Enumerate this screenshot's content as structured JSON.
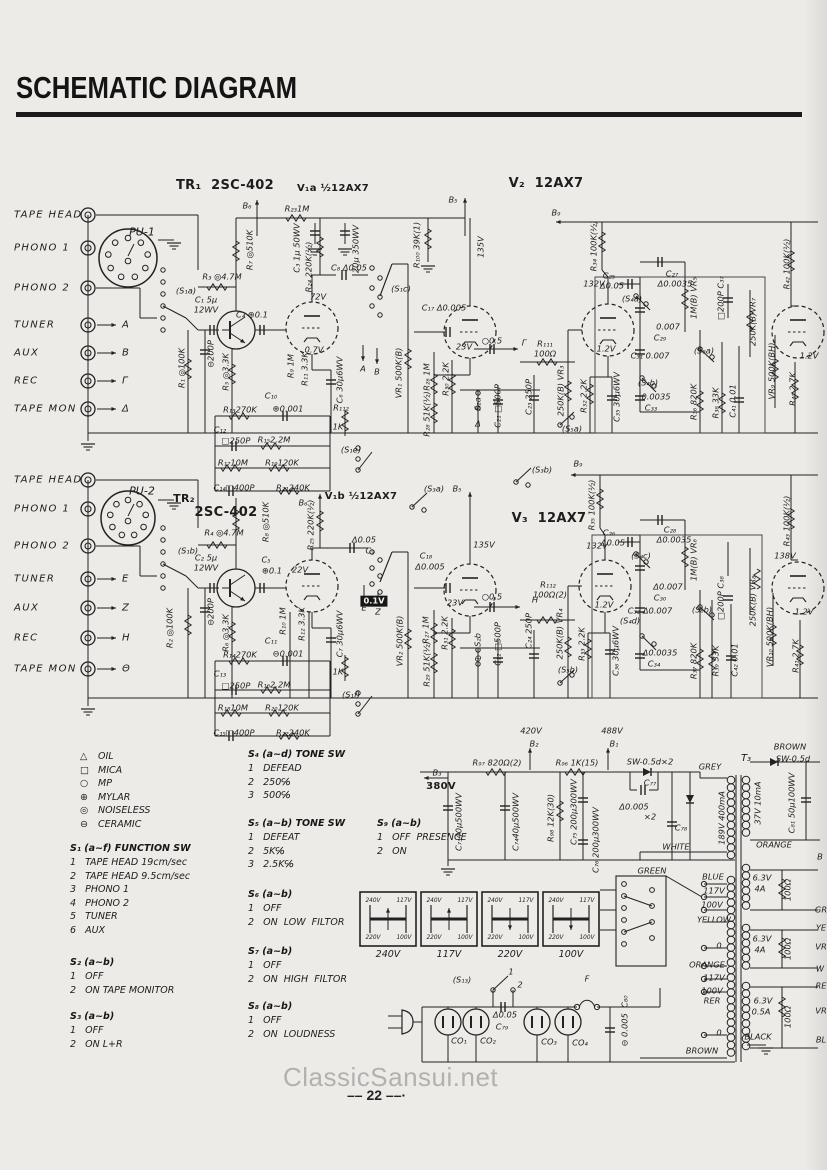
{
  "title": "SCHEMATIC DIAGRAM",
  "watermark": "ClassicSansui.net",
  "page_number": "22",
  "page_number_display": "–– 22 ––·",
  "colors": {
    "ink": "#1d1d1d",
    "paper": "#edebe7",
    "watermark_grey": "#b2b1af"
  },
  "input_groups": [
    {
      "connector": "PU-1",
      "rows": [
        {
          "label": "TAPE HEAD",
          "tag": ""
        },
        {
          "label": "PHONO  1",
          "tag": ""
        },
        {
          "label": "PHONO  2",
          "tag": ""
        },
        {
          "label": "TUNER",
          "tag": "A"
        },
        {
          "label": "AUX",
          "tag": "B"
        },
        {
          "label": "REC",
          "tag": "Γ"
        },
        {
          "label": "TAPE MON",
          "tag": "Δ"
        }
      ]
    },
    {
      "connector": "PU-2",
      "rows": [
        {
          "label": "TAPE HEAD",
          "tag": ""
        },
        {
          "label": "PHONO  1",
          "tag": ""
        },
        {
          "label": "PHONO  2",
          "tag": ""
        },
        {
          "label": "TUNER",
          "tag": "E"
        },
        {
          "label": "AUX",
          "tag": "Z"
        },
        {
          "label": "REC",
          "tag": "H"
        },
        {
          "label": "TAPE MON",
          "tag": "Θ"
        }
      ]
    }
  ],
  "legend": {
    "items": [
      [
        "△",
        "OIL"
      ],
      [
        "□",
        "MICA"
      ],
      [
        "○",
        "MP"
      ],
      [
        "⊕",
        "MYLAR"
      ],
      [
        "◎",
        "NOISELESS"
      ],
      [
        "⊖",
        "CERAMIC"
      ]
    ]
  },
  "switch_blocks": [
    {
      "title": "S₁ (a~f)  FUNCTION SW",
      "items": [
        "1   TAPE HEAD 19cm/sec",
        "2   TAPE HEAD 9.5cm/sec",
        "3   PHONO 1",
        "4   PHONO 2",
        "5   TUNER",
        "6   AUX"
      ]
    },
    {
      "title": "S₂ (a~b)",
      "items": [
        "1   OFF",
        "2   ON TAPE MONITOR"
      ]
    },
    {
      "title": "S₃ (a~b)",
      "items": [
        "1   OFF",
        "2   ON L+R"
      ]
    },
    {
      "title": "S₄ (a~d) TONE SW",
      "items": [
        "1   DEFEAD",
        "2   250℅",
        "3   500℅"
      ]
    },
    {
      "title": "S₅ (a~b) TONE SW",
      "items": [
        "1   DEFEAT",
        "2   5K℅",
        "3   2.5K℅"
      ]
    },
    {
      "title": "S₆ (a~b)",
      "items": [
        "1   OFF",
        "2   ON  LOW  FILTOR"
      ]
    },
    {
      "title": "S₇ (a~b)",
      "items": [
        "1   OFF",
        "2   ON  HIGH  FILTOR"
      ]
    },
    {
      "title": "S₈ (a~b)",
      "items": [
        "1   OFF",
        "2   ON  LOUDNESS"
      ]
    },
    {
      "title": "S₉ (a~b)",
      "items": [
        "1   OFF  PRESENCE",
        "2   ON"
      ]
    }
  ],
  "selectors": {
    "corners": [
      "240V",
      "117V",
      "220V",
      "100V"
    ],
    "captions": [
      "240V",
      "117V",
      "220V",
      "100V"
    ]
  },
  "annotations": [
    {
      "t": "TR₁  2SC-402",
      "x": 225,
      "y": 186,
      "s": 13,
      "b": 1
    },
    {
      "t": "V₁a ½12AX7",
      "x": 333,
      "y": 189,
      "s": 10,
      "b": 1
    },
    {
      "t": "V₂  12AX7",
      "x": 546,
      "y": 184,
      "s": 13,
      "b": 1
    },
    {
      "t": "B₆",
      "x": 247,
      "y": 206
    },
    {
      "t": "R₂₃1M",
      "x": 297,
      "y": 209
    },
    {
      "t": "B₅",
      "x": 453,
      "y": 200
    },
    {
      "t": "135V",
      "x": 481,
      "y": 247,
      "r": 1
    },
    {
      "t": "R₁₀₀ 39K(1)",
      "x": 417,
      "y": 245,
      "r": 1
    },
    {
      "t": "R₇ ◎510K",
      "x": 250,
      "y": 250,
      "r": 1
    },
    {
      "t": "R₃ ◎4.7M",
      "x": 222,
      "y": 277
    },
    {
      "t": "C₃ 1μ 50WV",
      "x": 297,
      "y": 248,
      "r": 1
    },
    {
      "t": "R₂₄ 220K(½)",
      "x": 309,
      "y": 267,
      "r": 1
    },
    {
      "t": "20μ 350WV",
      "x": 356,
      "y": 249,
      "r": 1
    },
    {
      "t": "C₈ Δ0.05",
      "x": 349,
      "y": 268
    },
    {
      "t": "(S₁c)",
      "x": 401,
      "y": 289
    },
    {
      "t": "C₁₇ Δ0.005",
      "x": 444,
      "y": 308
    },
    {
      "t": "(S₁a)",
      "x": 186,
      "y": 291
    },
    {
      "t": "C₁ 5μ",
      "x": 206,
      "y": 300
    },
    {
      "t": "12WV",
      "x": 206,
      "y": 310
    },
    {
      "t": "C₄ ⊕0.1",
      "x": 252,
      "y": 315
    },
    {
      "t": "72V",
      "x": 318,
      "y": 297
    },
    {
      "t": "0.7V",
      "x": 314,
      "y": 350
    },
    {
      "t": "23V",
      "x": 464,
      "y": 347
    },
    {
      "t": "A",
      "x": 363,
      "y": 369
    },
    {
      "t": "B",
      "x": 377,
      "y": 372
    },
    {
      "t": "⊖200P",
      "x": 211,
      "y": 354,
      "r": 1
    },
    {
      "t": "R₁ ◎100K",
      "x": 182,
      "y": 368,
      "r": 1
    },
    {
      "t": "R₅ ◎3.3K",
      "x": 226,
      "y": 372,
      "r": 1
    },
    {
      "t": "R₉ 1M",
      "x": 291,
      "y": 366,
      "r": 1
    },
    {
      "t": "R₁₁ 3.3K",
      "x": 305,
      "y": 369,
      "r": 1
    },
    {
      "t": "C₆ 30μ6WV",
      "x": 340,
      "y": 380,
      "r": 1
    },
    {
      "t": "VR₁ 500K(B)",
      "x": 399,
      "y": 373,
      "r": 1
    },
    {
      "t": "○0.5",
      "x": 492,
      "y": 341
    },
    {
      "t": "Γ",
      "x": 524,
      "y": 343
    },
    {
      "t": "R₂₆ 1M",
      "x": 427,
      "y": 377,
      "r": 1
    },
    {
      "t": "R₃₀ 2.2K",
      "x": 446,
      "y": 379,
      "r": 1
    },
    {
      "t": "R₂₈ 51K(½)",
      "x": 427,
      "y": 414,
      "r": 1
    },
    {
      "t": "S₂a",
      "x": 478,
      "y": 404,
      "r": 1
    },
    {
      "t": "Δ",
      "x": 478,
      "y": 424
    },
    {
      "t": "C₂₁ □500P",
      "x": 498,
      "y": 406,
      "r": 1
    },
    {
      "t": "C₂₃ 250P",
      "x": 529,
      "y": 397,
      "r": 1
    },
    {
      "t": "R₁₁₁",
      "x": 545,
      "y": 344
    },
    {
      "t": "100Ω",
      "x": 545,
      "y": 354
    },
    {
      "t": "250K(B) VR₃",
      "x": 561,
      "y": 391,
      "r": 1
    },
    {
      "t": "(S₅a)",
      "x": 572,
      "y": 429
    },
    {
      "t": "R₃₂ 2.2K",
      "x": 584,
      "y": 396,
      "r": 1
    },
    {
      "t": "C₃₅ 30μ6WV",
      "x": 617,
      "y": 397,
      "r": 1
    },
    {
      "t": "1.2V",
      "x": 606,
      "y": 349
    },
    {
      "t": "132V",
      "x": 594,
      "y": 284
    },
    {
      "t": "C₂₅",
      "x": 609,
      "y": 276
    },
    {
      "t": "Δ0.05",
      "x": 612,
      "y": 286
    },
    {
      "t": "(S₄a)",
      "x": 632,
      "y": 299
    },
    {
      "t": "C₂₇",
      "x": 672,
      "y": 274
    },
    {
      "t": "Δ0.0035",
      "x": 675,
      "y": 284
    },
    {
      "t": "1M(B) VR₅",
      "x": 694,
      "y": 298,
      "r": 1
    },
    {
      "t": "0.007",
      "x": 668,
      "y": 327
    },
    {
      "t": "C₂₉",
      "x": 660,
      "y": 338
    },
    {
      "t": "C₃₁ 0.007",
      "x": 650,
      "y": 356
    },
    {
      "t": "(S₄b)",
      "x": 648,
      "y": 383
    },
    {
      "t": "0.0035",
      "x": 656,
      "y": 397
    },
    {
      "t": "C₃₃",
      "x": 651,
      "y": 408
    },
    {
      "t": "R₃₆ 820K",
      "x": 694,
      "y": 402,
      "r": 1
    },
    {
      "t": "R₃₈ 33K",
      "x": 716,
      "y": 403,
      "r": 1
    },
    {
      "t": "C₄₁ 0.01",
      "x": 733,
      "y": 401,
      "r": 1
    },
    {
      "t": "(S₈a)",
      "x": 704,
      "y": 351
    },
    {
      "t": "□200P C₃₇",
      "x": 721,
      "y": 298,
      "r": 1
    },
    {
      "t": "250K(B)VR₇",
      "x": 753,
      "y": 322,
      "r": 1
    },
    {
      "t": "VR₉ 500K(BH)",
      "x": 772,
      "y": 371,
      "r": 1
    },
    {
      "t": "R₄₀ 2.7K",
      "x": 793,
      "y": 389,
      "r": 1
    },
    {
      "t": "R₄₂ 100K(½)",
      "x": 787,
      "y": 264,
      "r": 1
    },
    {
      "t": "1.2V",
      "x": 809,
      "y": 356
    },
    {
      "t": "R₃₄ 100K(½)",
      "x": 594,
      "y": 246,
      "r": 1
    },
    {
      "t": "B₉",
      "x": 556,
      "y": 213
    },
    {
      "t": "R₁₃270K",
      "x": 240,
      "y": 410
    },
    {
      "t": "C₁₀",
      "x": 271,
      "y": 396
    },
    {
      "t": "⊕0.001",
      "x": 288,
      "y": 409
    },
    {
      "t": "C₁₂",
      "x": 220,
      "y": 430
    },
    {
      "t": "□250P",
      "x": 236,
      "y": 441
    },
    {
      "t": "R₁₅2.2M",
      "x": 274,
      "y": 440
    },
    {
      "t": "R₁₁₂",
      "x": 341,
      "y": 408
    },
    {
      "t": "1K",
      "x": 338,
      "y": 427
    },
    {
      "t": "R₁₇10M",
      "x": 233,
      "y": 463
    },
    {
      "t": "R₁₉120K",
      "x": 282,
      "y": 463
    },
    {
      "t": "C₁₄□400P",
      "x": 234,
      "y": 488
    },
    {
      "t": "R₂₁240K",
      "x": 293,
      "y": 488
    },
    {
      "t": "(S₁e)",
      "x": 351,
      "y": 450
    },
    {
      "t": "(S₃a)",
      "x": 434,
      "y": 489
    },
    {
      "t": "(S₃b)",
      "x": 542,
      "y": 470
    },
    {
      "t": "B₉",
      "x": 578,
      "y": 464
    },
    {
      "t": "B₅",
      "x": 457,
      "y": 489
    },
    {
      "t": "TR₂",
      "x": 184,
      "y": 499,
      "s": 11,
      "b": 1
    },
    {
      "t": "2SC-402",
      "x": 226,
      "y": 513,
      "s": 13,
      "b": 1
    },
    {
      "t": "V₁b ½12AX7",
      "x": 361,
      "y": 497,
      "s": 10,
      "b": 1
    },
    {
      "t": "V₃  12AX7",
      "x": 549,
      "y": 519,
      "s": 13,
      "b": 1
    },
    {
      "t": "B₆",
      "x": 303,
      "y": 503
    },
    {
      "t": "R₂₅ 220K(½)",
      "x": 311,
      "y": 525,
      "r": 1
    },
    {
      "t": "R₈ ◎510K",
      "x": 266,
      "y": 522,
      "r": 1
    },
    {
      "t": "R₄ ◎4.7M",
      "x": 224,
      "y": 533
    },
    {
      "t": "(S₁b)",
      "x": 188,
      "y": 551
    },
    {
      "t": "C₂ 5μ",
      "x": 206,
      "y": 558
    },
    {
      "t": "12WV",
      "x": 206,
      "y": 568
    },
    {
      "t": "⊖200P",
      "x": 211,
      "y": 612,
      "r": 1
    },
    {
      "t": "R₂ ◎100K",
      "x": 170,
      "y": 628,
      "r": 1
    },
    {
      "t": "R₆ ◎3.3K",
      "x": 226,
      "y": 633,
      "r": 1
    },
    {
      "t": "C₅",
      "x": 266,
      "y": 560
    },
    {
      "t": "⊕0.1",
      "x": 272,
      "y": 571
    },
    {
      "t": "22V",
      "x": 300,
      "y": 570
    },
    {
      "t": "Δ0.05",
      "x": 364,
      "y": 540
    },
    {
      "t": "C₉",
      "x": 370,
      "y": 551
    },
    {
      "t": "0.1V",
      "x": 374,
      "y": 601,
      "w": 1
    },
    {
      "t": "E",
      "x": 364,
      "y": 608
    },
    {
      "t": "Z",
      "x": 378,
      "y": 612
    },
    {
      "t": "R₁₀ 1M",
      "x": 283,
      "y": 621,
      "r": 1
    },
    {
      "t": "R₁₂ 3.3K",
      "x": 302,
      "y": 624,
      "r": 1
    },
    {
      "t": "C₇ 30μ6WV",
      "x": 340,
      "y": 634,
      "r": 1
    },
    {
      "t": "VR₂ 500K(B)",
      "x": 400,
      "y": 641,
      "r": 1
    },
    {
      "t": "C₁₈",
      "x": 426,
      "y": 556
    },
    {
      "t": "Δ0.005",
      "x": 430,
      "y": 567
    },
    {
      "t": "135V",
      "x": 484,
      "y": 545
    },
    {
      "t": "23V",
      "x": 455,
      "y": 603
    },
    {
      "t": "○0.5",
      "x": 492,
      "y": 597
    },
    {
      "t": "H",
      "x": 535,
      "y": 600
    },
    {
      "t": "R₂₇ 1M",
      "x": 426,
      "y": 630,
      "r": 1
    },
    {
      "t": "R₃₁ 2.2K",
      "x": 445,
      "y": 633,
      "r": 1
    },
    {
      "t": "R₂₉ 51K(½)",
      "x": 427,
      "y": 664,
      "r": 1
    },
    {
      "t": "S₂b",
      "x": 478,
      "y": 640,
      "r": 1
    },
    {
      "t": "Θ",
      "x": 478,
      "y": 659
    },
    {
      "t": "C₂₂ □500P",
      "x": 498,
      "y": 644,
      "r": 1
    },
    {
      "t": "C₂₄ 250P",
      "x": 529,
      "y": 631,
      "r": 1
    },
    {
      "t": "R₁₁₂",
      "x": 548,
      "y": 585
    },
    {
      "t": "100Ω(2)",
      "x": 550,
      "y": 595
    },
    {
      "t": "250K(B) VR₄",
      "x": 560,
      "y": 634,
      "r": 1
    },
    {
      "t": "(S₅b)",
      "x": 568,
      "y": 670
    },
    {
      "t": "R₃₃ 2.2K",
      "x": 582,
      "y": 644,
      "r": 1
    },
    {
      "t": "C₃₆ 30μ6WV",
      "x": 616,
      "y": 651,
      "r": 1
    },
    {
      "t": "1.2V",
      "x": 604,
      "y": 605
    },
    {
      "t": "(S₄d)",
      "x": 630,
      "y": 621
    },
    {
      "t": "132V",
      "x": 597,
      "y": 546
    },
    {
      "t": "C₂₆",
      "x": 609,
      "y": 533
    },
    {
      "t": "Δ0.05",
      "x": 613,
      "y": 543
    },
    {
      "t": "(S₄c)",
      "x": 641,
      "y": 556
    },
    {
      "t": "C₂₈",
      "x": 670,
      "y": 530
    },
    {
      "t": "Δ0.0035",
      "x": 674,
      "y": 540
    },
    {
      "t": "1M(B) VR₆",
      "x": 694,
      "y": 560,
      "r": 1
    },
    {
      "t": "Δ0.007",
      "x": 668,
      "y": 587
    },
    {
      "t": "C₃₀",
      "x": 660,
      "y": 598
    },
    {
      "t": "C₃₂ Δ0.007",
      "x": 650,
      "y": 611
    },
    {
      "t": "Δ0.0035",
      "x": 660,
      "y": 653
    },
    {
      "t": "C₃₄",
      "x": 654,
      "y": 664
    },
    {
      "t": "R₃₇ 820K",
      "x": 694,
      "y": 661,
      "r": 1
    },
    {
      "t": "R₃₉ 33K",
      "x": 716,
      "y": 661,
      "r": 1
    },
    {
      "t": "C₄₂ 0.01",
      "x": 735,
      "y": 660,
      "r": 1
    },
    {
      "t": "(S₈b)",
      "x": 702,
      "y": 610
    },
    {
      "t": "□200P C₃₈",
      "x": 721,
      "y": 598,
      "r": 1
    },
    {
      "t": "250K(B) VR₈",
      "x": 753,
      "y": 601,
      "r": 1
    },
    {
      "t": "VR₁₀ 500K(BH)",
      "x": 770,
      "y": 637,
      "r": 1
    },
    {
      "t": "R₄₁ 2.7K",
      "x": 796,
      "y": 656,
      "r": 1
    },
    {
      "t": "R₄₃ 100K(½)",
      "x": 787,
      "y": 521,
      "r": 1
    },
    {
      "t": "138V",
      "x": 785,
      "y": 556
    },
    {
      "t": "1.2V",
      "x": 804,
      "y": 612
    },
    {
      "t": "R₃₅ 100K(½)",
      "x": 592,
      "y": 505,
      "r": 1
    },
    {
      "t": "R₁₄270K",
      "x": 240,
      "y": 655
    },
    {
      "t": "C₁₁",
      "x": 271,
      "y": 641
    },
    {
      "t": "⊖0.001",
      "x": 288,
      "y": 654
    },
    {
      "t": "C₁₃",
      "x": 220,
      "y": 674
    },
    {
      "t": "□250P",
      "x": 236,
      "y": 686
    },
    {
      "t": "R₁₆2.2M",
      "x": 274,
      "y": 685
    },
    {
      "t": "1K",
      "x": 338,
      "y": 672
    },
    {
      "t": "R₁₈10M",
      "x": 233,
      "y": 708
    },
    {
      "t": "R₂₀120K",
      "x": 282,
      "y": 708
    },
    {
      "t": "C₁₅□400P",
      "x": 234,
      "y": 733
    },
    {
      "t": "R₂₂240K",
      "x": 293,
      "y": 733
    },
    {
      "t": "(S₁f)",
      "x": 351,
      "y": 695
    },
    {
      "t": "420V",
      "x": 531,
      "y": 731
    },
    {
      "t": "B₂",
      "x": 534,
      "y": 744
    },
    {
      "t": "488V",
      "x": 612,
      "y": 731
    },
    {
      "t": "B₁",
      "x": 614,
      "y": 744
    },
    {
      "t": "B₃",
      "x": 437,
      "y": 773
    },
    {
      "t": "380V",
      "x": 441,
      "y": 787,
      "b": 1,
      "s": 10
    },
    {
      "t": "R₉₇ 820Ω(2)",
      "x": 497,
      "y": 763
    },
    {
      "t": "R₉₆ 1K(15)",
      "x": 577,
      "y": 763
    },
    {
      "t": "SW-0.5d×2",
      "x": 650,
      "y": 762
    },
    {
      "t": "C₇₃40μ500WV",
      "x": 459,
      "y": 822,
      "r": 1
    },
    {
      "t": "C₇₄40μ500WV",
      "x": 516,
      "y": 822,
      "r": 1
    },
    {
      "t": "R₉₈ 12K(30)",
      "x": 551,
      "y": 818,
      "r": 1
    },
    {
      "t": "C₇₅ 200μ300WV",
      "x": 574,
      "y": 812,
      "r": 1
    },
    {
      "t": "C₇₆ 200μ300WV",
      "x": 596,
      "y": 840,
      "r": 1
    },
    {
      "t": "C₇₇",
      "x": 650,
      "y": 783
    },
    {
      "t": "Δ0.005",
      "x": 634,
      "y": 807
    },
    {
      "t": "×2",
      "x": 650,
      "y": 817
    },
    {
      "t": "C₇₈",
      "x": 681,
      "y": 828
    },
    {
      "t": "GREY",
      "x": 710,
      "y": 767
    },
    {
      "t": "189V 400mA",
      "x": 722,
      "y": 818,
      "r": 1
    },
    {
      "t": "WHITE",
      "x": 676,
      "y": 847
    },
    {
      "t": "T₃",
      "x": 746,
      "y": 759,
      "s": 10
    },
    {
      "t": "BROWN",
      "x": 790,
      "y": 747
    },
    {
      "t": "SW-0.5d",
      "x": 793,
      "y": 759
    },
    {
      "t": "37V 10mA",
      "x": 758,
      "y": 803,
      "r": 1
    },
    {
      "t": "C₈₁ 50μ100WV",
      "x": 792,
      "y": 803,
      "r": 1
    },
    {
      "t": "ORANGE",
      "x": 774,
      "y": 845
    },
    {
      "t": "6.3V",
      "x": 762,
      "y": 878
    },
    {
      "t": "4A",
      "x": 760,
      "y": 889
    },
    {
      "t": "100Ω",
      "x": 788,
      "y": 890,
      "r": 1
    },
    {
      "t": "6.3V",
      "x": 762,
      "y": 939
    },
    {
      "t": "4A",
      "x": 760,
      "y": 950
    },
    {
      "t": "100Ω",
      "x": 788,
      "y": 949,
      "r": 1
    },
    {
      "t": "6.3V",
      "x": 763,
      "y": 1001
    },
    {
      "t": "0.5A",
      "x": 761,
      "y": 1012
    },
    {
      "t": "100Ω",
      "x": 788,
      "y": 1017,
      "r": 1
    },
    {
      "t": "GREEN",
      "x": 652,
      "y": 871
    },
    {
      "t": "BLUE",
      "x": 713,
      "y": 877
    },
    {
      "t": "117V",
      "x": 714,
      "y": 891
    },
    {
      "t": "100V",
      "x": 712,
      "y": 905
    },
    {
      "t": "YELLOW",
      "x": 714,
      "y": 920
    },
    {
      "t": "0",
      "x": 719,
      "y": 946
    },
    {
      "t": "ORANGE",
      "x": 707,
      "y": 965
    },
    {
      "t": "117V",
      "x": 714,
      "y": 978
    },
    {
      "t": "100V",
      "x": 712,
      "y": 991
    },
    {
      "t": "RER",
      "x": 712,
      "y": 1001
    },
    {
      "t": "0",
      "x": 719,
      "y": 1033
    },
    {
      "t": "BROWN",
      "x": 702,
      "y": 1051
    },
    {
      "t": "BLACK",
      "x": 758,
      "y": 1037
    },
    {
      "t": "B",
      "x": 820,
      "y": 857
    },
    {
      "t": "GR",
      "x": 821,
      "y": 910
    },
    {
      "t": "YE",
      "x": 821,
      "y": 928
    },
    {
      "t": "VR",
      "x": 821,
      "y": 947
    },
    {
      "t": "W",
      "x": 820,
      "y": 969
    },
    {
      "t": "RE",
      "x": 821,
      "y": 986
    },
    {
      "t": "VR",
      "x": 821,
      "y": 1011
    },
    {
      "t": "BL",
      "x": 821,
      "y": 1040
    },
    {
      "t": "(S₁₃)",
      "x": 462,
      "y": 980
    },
    {
      "t": "1",
      "x": 511,
      "y": 972
    },
    {
      "t": "2",
      "x": 520,
      "y": 985
    },
    {
      "t": "Δ0.05",
      "x": 505,
      "y": 1015
    },
    {
      "t": "C₇₉",
      "x": 502,
      "y": 1027
    },
    {
      "t": "CO₁",
      "x": 459,
      "y": 1041
    },
    {
      "t": "CO₂",
      "x": 488,
      "y": 1041
    },
    {
      "t": "CO₃",
      "x": 549,
      "y": 1042
    },
    {
      "t": "CO₄",
      "x": 580,
      "y": 1043
    },
    {
      "t": "F",
      "x": 587,
      "y": 979
    },
    {
      "t": "⊖ 0.005  C₈₀",
      "x": 625,
      "y": 1021,
      "r": 1
    }
  ]
}
